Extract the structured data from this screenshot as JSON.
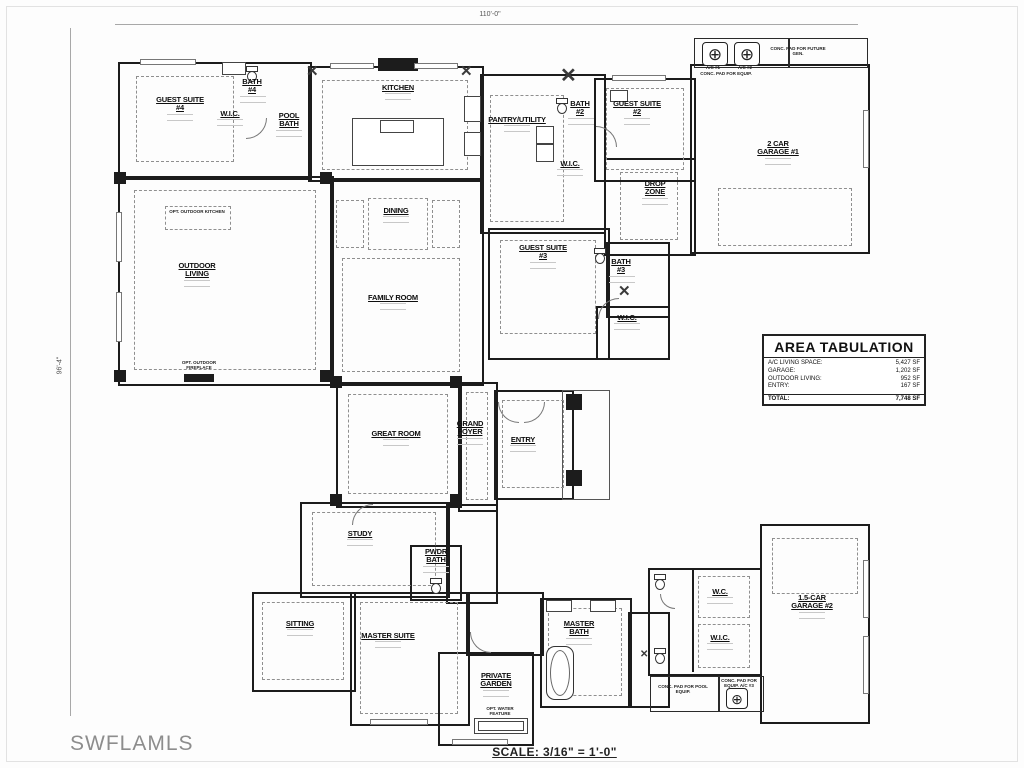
{
  "drawing": {
    "watermark": "SWFLAMLS",
    "scale_label": "SCALE: 3/16\" = 1'-0\"",
    "dimensions": {
      "top": "110'-0\"",
      "left": "96'-4\""
    }
  },
  "area_tabulation": {
    "title": "AREA TABULATION",
    "rows": [
      {
        "label": "A/C LIVING SPACE:",
        "value": "5,427 SF"
      },
      {
        "label": "GARAGE:",
        "value": "1,202 SF"
      },
      {
        "label": "OUTDOOR LIVING:",
        "value": "952 SF"
      },
      {
        "label": "ENTRY:",
        "value": "167 SF"
      }
    ],
    "total": {
      "label": "TOTAL:",
      "value": "7,748 SF"
    }
  },
  "rooms": [
    {
      "name": "GUEST SUITE #4"
    },
    {
      "name": "BATH #4"
    },
    {
      "name": "W.I.C."
    },
    {
      "name": "POOL BATH"
    },
    {
      "name": "KITCHEN"
    },
    {
      "name": "PANTRY/UTILITY"
    },
    {
      "name": "BATH #2"
    },
    {
      "name": "W.I.C."
    },
    {
      "name": "GUEST SUITE #2"
    },
    {
      "name": "DROP ZONE"
    },
    {
      "name": "2 CAR GARAGE #1"
    },
    {
      "name": "OUTDOOR LIVING"
    },
    {
      "name": "DINING"
    },
    {
      "name": "FAMILY ROOM"
    },
    {
      "name": "GUEST SUITE #3"
    },
    {
      "name": "BATH #3"
    },
    {
      "name": "W.I.C."
    },
    {
      "name": "GREAT ROOM"
    },
    {
      "name": "GRAND FOYER"
    },
    {
      "name": "ENTRY"
    },
    {
      "name": "STUDY"
    },
    {
      "name": "PWDR BATH"
    },
    {
      "name": "SITTING"
    },
    {
      "name": "MASTER SUITE"
    },
    {
      "name": "PRIVATE GARDEN"
    },
    {
      "name": "MASTER BATH"
    },
    {
      "name": "W.C."
    },
    {
      "name": "W.I.C."
    },
    {
      "name": "1.5-CAR GARAGE #2"
    }
  ],
  "annotations": [
    {
      "text": "OPT. OUTDOOR KITCHEN"
    },
    {
      "text": "OPT. OUTDOOR FIREPLACE"
    },
    {
      "text": "OPT. WATER FEATURE"
    },
    {
      "text": "A/C #1"
    },
    {
      "text": "A/C #2"
    },
    {
      "text": "CONC. PAD FOR EQUIP."
    },
    {
      "text": "CONC. PAD FOR FUTURE GEN."
    },
    {
      "text": "CONC. PAD FOR POOL EQUIP."
    },
    {
      "text": "CONC. PAD FOR EQUIP. A/C #3"
    }
  ],
  "icons": {
    "ac_unit": "⊕",
    "shower_x": "✕"
  }
}
